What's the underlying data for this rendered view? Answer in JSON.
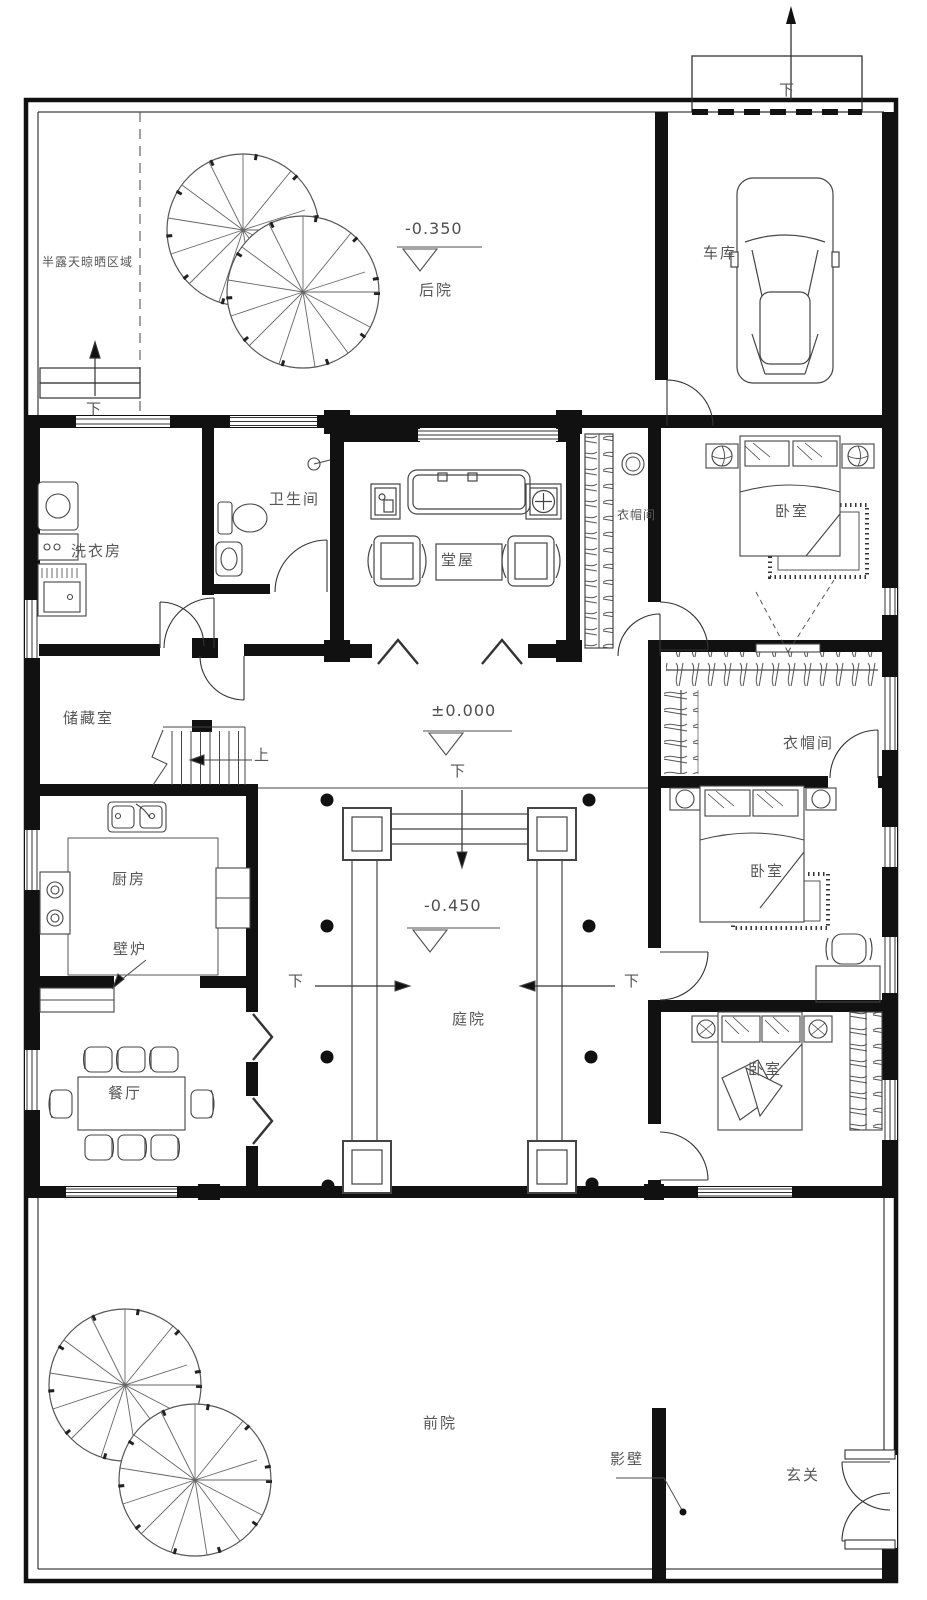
{
  "plan": {
    "title": "courtyard-house-floor-plan",
    "areas": {
      "drying_area": "半露天晾晒区域",
      "backyard": "后院",
      "garage": "车库",
      "courtyard": "庭院",
      "front_yard": "前院",
      "screen_wall": "影壁",
      "entrance": "玄关"
    },
    "rooms": {
      "laundry": "洗衣房",
      "bathroom": "卫生间",
      "hall": "堂屋",
      "cloakroom_top": "衣帽间",
      "bedroom_top": "卧室",
      "storage": "储藏室",
      "cloakroom_right": "衣帽间",
      "kitchen": "厨房",
      "fireplace": "壁炉",
      "bedroom_mid": "卧室",
      "dining": "餐厅",
      "bedroom_bottom": "卧室"
    },
    "elevations": {
      "backyard": "-0.350",
      "ground": "±0.000",
      "courtyard": "-0.450"
    },
    "markers": {
      "down": "下",
      "up": "上"
    },
    "colors": {
      "wall": "#111111",
      "line": "#474747",
      "text": "#565656",
      "background": "#ffffff"
    }
  }
}
